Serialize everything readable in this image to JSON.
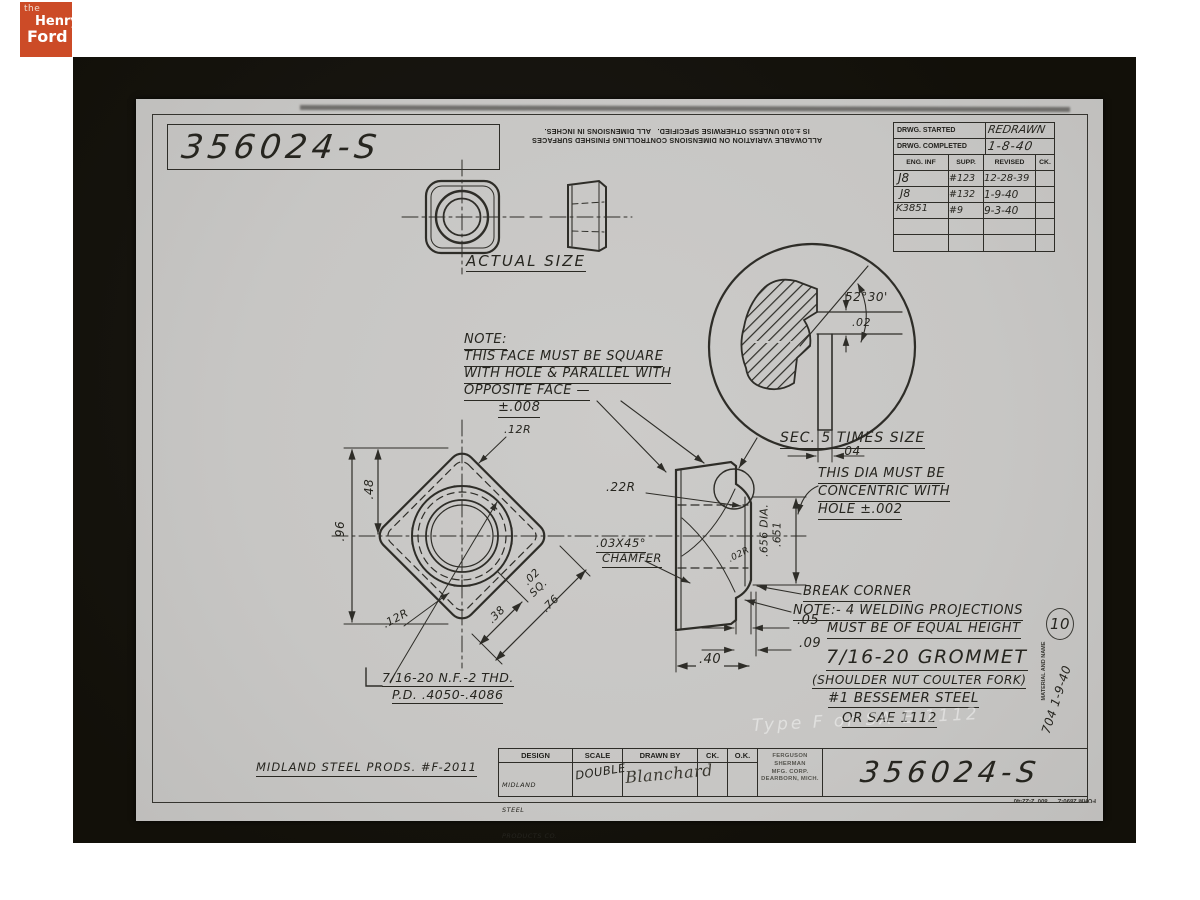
{
  "logo": {
    "the": "the",
    "henry": "Henry",
    "ford": "Ford"
  },
  "drawing_number": "356024-S",
  "tolerance_note": {
    "line1": "ALLOWABLE VARIATION ON DIMENSIONS CONTROLLING FINISHED SURFACES",
    "line2": "IS ±.010 UNLESS OTHERWISE SPECIFIED.   ALL DIMENSIONS IN INCHES."
  },
  "revision_table": {
    "started_label": "DRWG. STARTED",
    "started_value": "REDRAWN",
    "completed_label": "DRWG. COMPLETED",
    "completed_value": "1-8-40",
    "headers": [
      "ENG. INF",
      "SUPP.",
      "REVISED",
      "CK."
    ],
    "rows": [
      [
        "J8",
        "#123",
        "12-28-39",
        ""
      ],
      [
        "J8",
        "#132",
        "1-9-40",
        ""
      ],
      [
        "K3851",
        "#9",
        "9-3-40",
        ""
      ],
      [
        "",
        "",
        "",
        ""
      ],
      [
        "",
        "",
        "",
        ""
      ]
    ]
  },
  "labels": {
    "actual_size": "ACTUAL SIZE",
    "section": "SEC. 5 TIMES SIZE"
  },
  "face_note": {
    "l1": "NOTE:",
    "l2": "THIS FACE MUST BE SQUARE",
    "l3": "WITH HOLE & PARALLEL WITH",
    "l4": "OPPOSITE FACE —",
    "l5": "±.008"
  },
  "dia_note": {
    "l1": "THIS DIA MUST BE",
    "l2": "CONCENTRIC WITH",
    "l3": "HOLE ±.002"
  },
  "break_corner": "BREAK CORNER",
  "welding_note": {
    "l1": "NOTE:- 4 WELDING PROJECTIONS",
    "l2": "MUST BE OF EQUAL HEIGHT"
  },
  "thread_note": {
    "l1": "7/16-20 N.F.-2 THD.",
    "l2": "P.D. .4050-.4086"
  },
  "dims": {
    "d96": ".96",
    "d48": ".48",
    "r12_top": ".12R",
    "r12_bottom": ".12R",
    "d38": ".38",
    "d02sq": ".02",
    "sq": "SQ.",
    "d76": ".76",
    "r22": ".22R",
    "chamfer1": ".03X45°",
    "chamfer2": "CHAMFER",
    "r02": ".02R",
    "d656": ".656 DIA.",
    "d651": ".651",
    "d05": ".05",
    "d09": ".09",
    "d40": ".40",
    "angle": "52°30'",
    "s02": ".02",
    "s04": ".04"
  },
  "title": {
    "l1": "7/16-20 GROMMET",
    "l2": "(SHOULDER NUT COULTER FORK)",
    "l3": "#1 BESSEMER STEEL",
    "l4": "OR SAE 1112"
  },
  "material_and_name": "MATERIAL AND NAME",
  "material_date": "704 1-9-40",
  "page_number": "10",
  "ghost_text": "Type F or SA E 1112",
  "title_block": {
    "design_label": "DESIGN",
    "design_value1": "MIDLAND",
    "design_value2": "STEEL",
    "design_value3": "PRODUCTS CO.",
    "scale_label": "SCALE",
    "scale_value": "DOUBLE",
    "drawn_label": "DRAWN BY",
    "drawn_value": "Blanchard",
    "ck_label": "CK.",
    "ok_label": "O.K.",
    "stamp": {
      "l1": "FERGUSON",
      "l2": "SHERMAN",
      "l3": "MFG. CORP.",
      "l4": "DEARBORN, MICH."
    },
    "number": "356024-S"
  },
  "footer_note": "MIDLAND STEEL PRODS. #F-2011",
  "form_note": "FORM 2890-Z      800  2-22-40"
}
